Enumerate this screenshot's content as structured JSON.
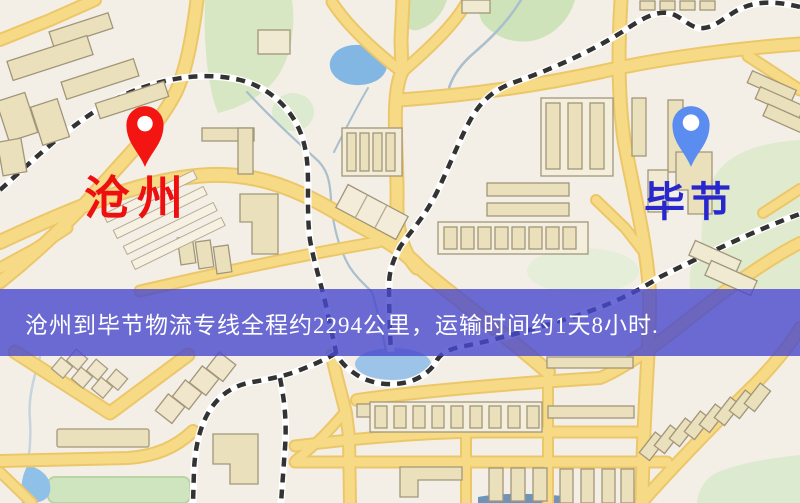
{
  "banner": {
    "text": "沧州到毕节物流专线全程约2294公里，运输时间约1天8小时.",
    "bg_color": "#4949cd",
    "text_color": "#ffffff"
  },
  "markers": [
    {
      "id": "origin",
      "label": "沧州",
      "pin_color": "#f21511",
      "label_color": "#ee1010"
    },
    {
      "id": "destination",
      "label": "毕节",
      "pin_color": "#5b8cf0",
      "label_color": "#2727cd"
    }
  ],
  "map_palette": {
    "background": "#f4efe6",
    "road_fill": "#f7da85",
    "road_edge": "#ecc76a",
    "water": "#8fbfe8",
    "lake": "#83b7e3",
    "park": "#d8e7c5",
    "building": "#ebe0bc",
    "building_edge": "#a2967a",
    "railway": "#333333"
  }
}
